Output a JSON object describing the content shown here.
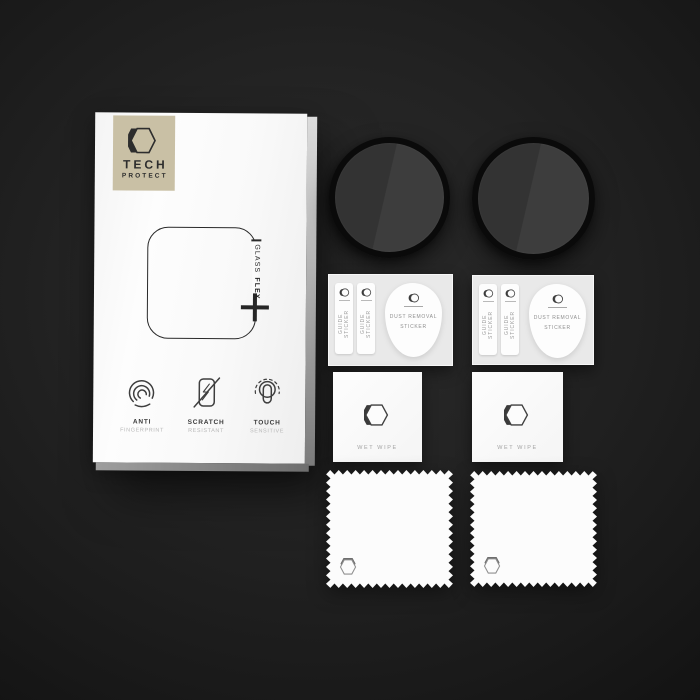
{
  "colors": {
    "background_center": "#2a2a2a",
    "background_edge": "#101010",
    "box_face": "#fbfbfb",
    "brand_badge_bg": "#c9c0a5",
    "ink": "#2a2a2a",
    "muted_text": "#9b9b9b",
    "glass_ring": "#0a0a0a",
    "glass_face_dark": "#333333",
    "glass_face_light": "#3d3d3d",
    "card_bg": "#e9e9e9"
  },
  "brand": {
    "line1": "TECH",
    "line2": "PROTECT"
  },
  "box": {
    "product_regular": "GLASS",
    "product_bold": "FLEX",
    "features": [
      {
        "icon": "fingerprint-icon",
        "title": "ANTI",
        "subtitle": "FINGERPRINT"
      },
      {
        "icon": "scratch-phone-icon",
        "title": "SCRATCH",
        "subtitle": "RESISTANT"
      },
      {
        "icon": "touch-finger-icon",
        "title": "TOUCH",
        "subtitle": "SENSITIVE"
      }
    ]
  },
  "accessories": {
    "guide_sticker_label": "GUIDE STICKER",
    "dust_removal_line1": "DUST REMOVAL",
    "dust_removal_line2": "STICKER",
    "wet_wipe_label": "WET WIPE"
  },
  "icons": {
    "brand_logo": "double-hexagon-logo",
    "sticker_logo": "circle-crescent-logo",
    "wipe_logo": "hexagon-crescent-logo",
    "cloth_logo": "hexagon-emboss-logo",
    "glass_plus": "plus-icon"
  }
}
